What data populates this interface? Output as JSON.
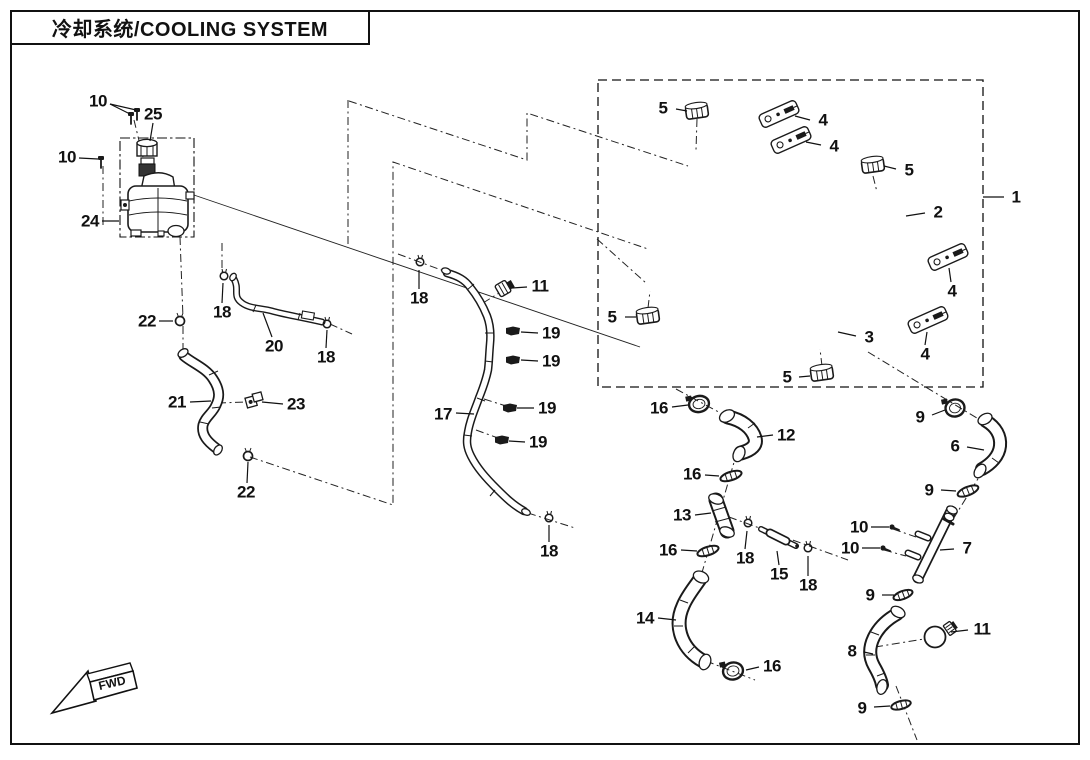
{
  "title": "冷却系统/COOLING SYSTEM",
  "fwd_label": "FWD",
  "callouts": [
    "10",
    "25",
    "10",
    "24",
    "22",
    "18",
    "20",
    "18",
    "21",
    "23",
    "22",
    "17",
    "18",
    "11",
    "19",
    "19",
    "19",
    "19",
    "18",
    "5",
    "4",
    "4",
    "5",
    "2",
    "1",
    "5",
    "3",
    "5",
    "4",
    "4",
    "16",
    "12",
    "9",
    "6",
    "16",
    "9",
    "13",
    "18",
    "15",
    "18",
    "10",
    "10",
    "7",
    "16",
    "14",
    "9",
    "16",
    "11",
    "8",
    "9"
  ]
}
